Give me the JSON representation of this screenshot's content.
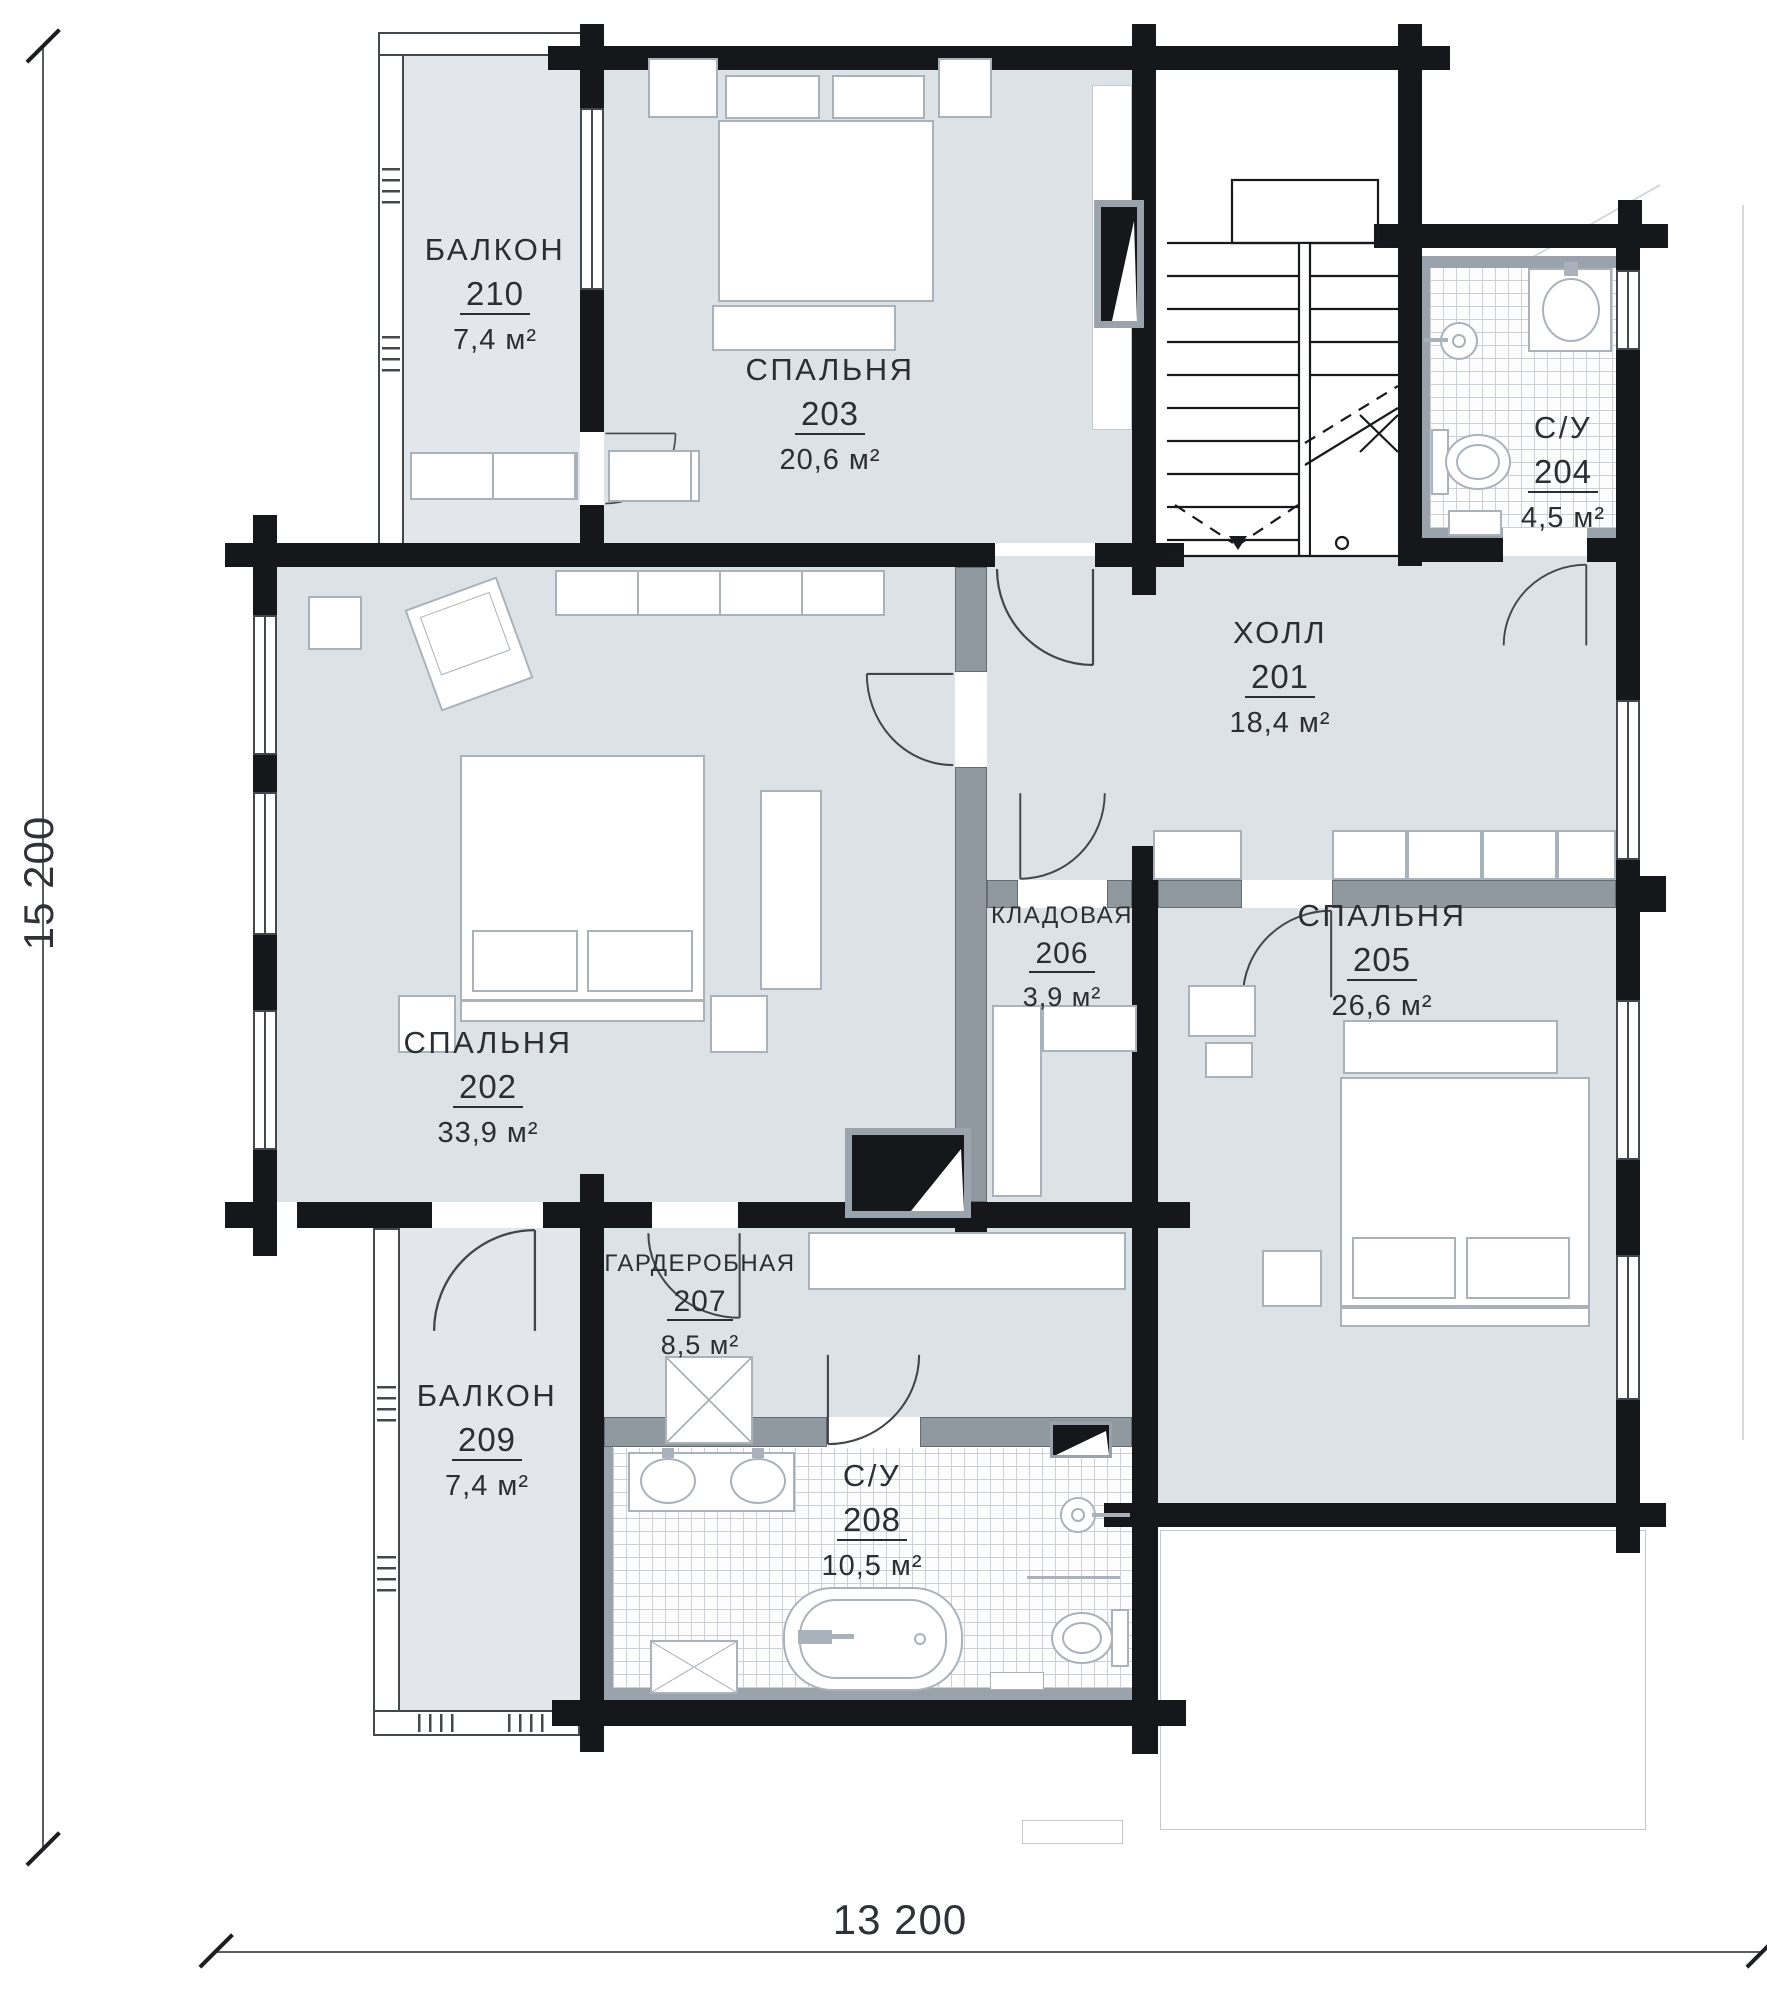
{
  "rooms": [
    {
      "name": "ХОЛЛ",
      "number": "201",
      "area": "18,4 м²"
    },
    {
      "name": "СПАЛЬНЯ",
      "number": "202",
      "area": "33,9 м²"
    },
    {
      "name": "СПАЛЬНЯ",
      "number": "203",
      "area": "20,6 м²"
    },
    {
      "name": "С/У",
      "number": "204",
      "area": "4,5 м²"
    },
    {
      "name": "СПАЛЬНЯ",
      "number": "205",
      "area": "26,6 м²"
    },
    {
      "name": "КЛАДОВАЯ",
      "number": "206",
      "area": "3,9 м²"
    },
    {
      "name": "ГАРДЕРОБНАЯ",
      "number": "207",
      "area": "8,5 м²"
    },
    {
      "name": "С/У",
      "number": "208",
      "area": "10,5 м²"
    },
    {
      "name": "БАЛКОН",
      "number": "209",
      "area": "7,4 м²"
    },
    {
      "name": "БАЛКОН",
      "number": "210",
      "area": "7,4 м²"
    }
  ],
  "dimensions": {
    "bottom_width": "13 200",
    "left_height": "15 200"
  },
  "colors": {
    "wall": "#15171b",
    "room_fill": "#dde2e7",
    "balcony_fill": "#e3e7ec",
    "partition": "#9098a0",
    "furniture_line": "#a9b1ba"
  }
}
